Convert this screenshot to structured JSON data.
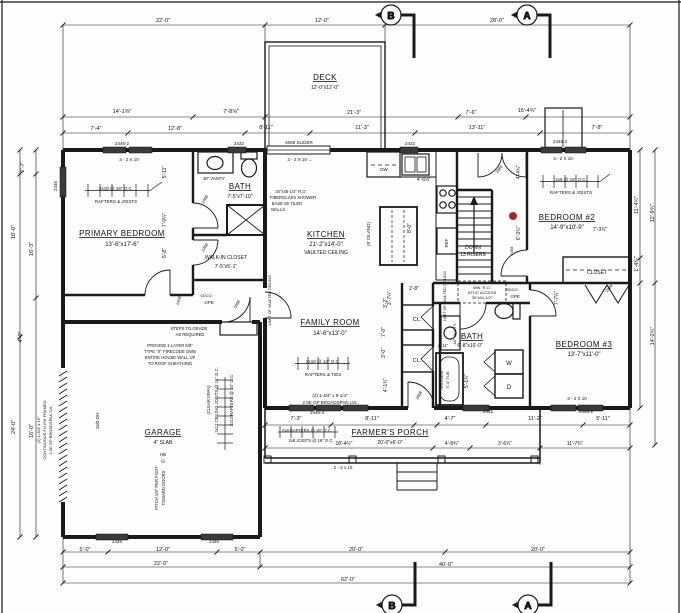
{
  "drawing_type": "first-floor architectural plan",
  "colors": {
    "paper": "#fdfdfd",
    "line": "#1a1a1a",
    "window_fill": "#3a3a3a",
    "red_marker": "#9e2b25"
  },
  "section_markers": {
    "top_b": "B",
    "top_a": "A",
    "bottom_b": "B",
    "bottom_a": "A"
  },
  "rooms": {
    "deck": {
      "name": "DECK",
      "dims": "12'-0\"x12'-0\""
    },
    "primary_bedroom": {
      "name": "PRIMARY BEDROOM",
      "dims": "13'-6\"x17'-6\""
    },
    "bath1": {
      "name": "BATH",
      "dims": "7'-5\"x7'-10\""
    },
    "walkin_closet": {
      "name": "WALK-IN CLOSET",
      "dims": "7'-5\"x5'-1\""
    },
    "kitchen": {
      "name": "KITCHEN",
      "dims": "21'-2\"x14'-0\"",
      "note": "VAULTED CEILING"
    },
    "family_room": {
      "name": "FAMILY ROOM",
      "dims": "14'-6\"x13'-0\""
    },
    "bedroom2": {
      "name": "BEDROOM #2",
      "dims": "14'-9\"x10'-9\""
    },
    "bedroom3": {
      "name": "BEDROOM #3",
      "dims": "13'-7\"x11'-0\""
    },
    "bath2": {
      "name": "BATH",
      "dims": "6'-8\"x10'-0\""
    },
    "garage": {
      "name": "GARAGE",
      "dims": "4\" SLAB"
    },
    "porch": {
      "name": "FARMER'S PORCH",
      "dims": "20'-0\"x6'-0\""
    },
    "closet2": {
      "name": "CLOSET"
    },
    "stairs": {
      "line1": "DOWN",
      "line2": "13 RISERS"
    }
  },
  "labels": [
    {
      "t": "22'-0\"",
      "x": 163,
      "y": 22
    },
    {
      "t": "12'-0\"",
      "x": 322,
      "y": 22
    },
    {
      "t": "28'-0\"",
      "x": 497,
      "y": 22
    },
    {
      "t": "14'-1⅜\"",
      "x": 122,
      "y": 113
    },
    {
      "t": "7'-8⅝\"",
      "x": 231,
      "y": 113
    },
    {
      "t": "21'-3\"",
      "x": 354,
      "y": 114
    },
    {
      "t": "7'-6\"",
      "x": 471,
      "y": 114
    },
    {
      "t": "15'-4¾\"",
      "x": 527,
      "y": 112
    },
    {
      "t": "7'-4\"",
      "x": 96,
      "y": 130
    },
    {
      "t": "12'-8\"",
      "x": 175,
      "y": 130
    },
    {
      "t": "8'-11\"",
      "x": 266,
      "y": 129
    },
    {
      "t": "11'-3\"",
      "x": 362,
      "y": 129
    },
    {
      "t": "13'-11\"",
      "x": 477,
      "y": 129
    },
    {
      "t": "7'-8\"",
      "x": 597,
      "y": 129
    },
    {
      "t": "2446-2",
      "x": 122,
      "y": 145,
      "s": 4.5
    },
    {
      "t": "2432",
      "x": 239,
      "y": 145,
      "s": 4.5
    },
    {
      "t": "6068 SLIDER",
      "x": 299,
      "y": 144,
      "s": 4.5
    },
    {
      "t": "2432",
      "x": 410,
      "y": 145,
      "s": 4.5
    },
    {
      "t": "2446-2",
      "x": 560,
      "y": 143,
      "s": 4.5
    },
    {
      "t": "3 - 2 X 10",
      "x": 129,
      "y": 161,
      "s": 4.5
    },
    {
      "t": "3 - 2 X 10  ←",
      "x": 300,
      "y": 161,
      "s": 4.5
    },
    {
      "t": "3 - 2 X 10",
      "x": 563,
      "y": 160,
      "s": 4.5
    },
    {
      "t": "2446",
      "x": 57,
      "y": 186,
      "r": -90,
      "s": 4.5
    },
    {
      "t": "2'-7\"",
      "x": 24,
      "y": 167,
      "r": -90
    },
    {
      "t": "18'-0\"",
      "x": 15,
      "y": 232,
      "r": -90
    },
    {
      "t": "16'-3\"",
      "x": 33,
      "y": 249,
      "r": -90
    },
    {
      "t": "4'-0\"",
      "x": 22,
      "y": 337,
      "r": -90
    },
    {
      "t": "24'-0\"",
      "x": 15,
      "y": 427,
      "r": -90
    },
    {
      "t": "16'-0\"",
      "x": 33,
      "y": 431,
      "r": -90
    },
    {
      "t": "11'-4¾\"",
      "x": 638,
      "y": 205,
      "r": -90
    },
    {
      "t": "12'-9¾\"",
      "x": 654,
      "y": 213,
      "r": -90
    },
    {
      "t": "1'-4¾\"",
      "x": 638,
      "y": 264,
      "r": -90
    },
    {
      "t": "14'-2¾\"",
      "x": 654,
      "y": 336,
      "r": -90
    },
    {
      "t": "7'-3\"",
      "x": 296,
      "y": 420
    },
    {
      "t": "8'-11\"",
      "x": 372,
      "y": 420
    },
    {
      "t": "4'-7\"",
      "x": 450,
      "y": 420
    },
    {
      "t": "11'-2\"",
      "x": 535,
      "y": 420
    },
    {
      "t": "5'-11\"",
      "x": 603,
      "y": 420
    },
    {
      "t": "18'-4½\"",
      "x": 344,
      "y": 445,
      "s": 5
    },
    {
      "t": "4'-8¾\"",
      "x": 452,
      "y": 445,
      "s": 5
    },
    {
      "t": "3'-6¾\"",
      "x": 505,
      "y": 445,
      "s": 5
    },
    {
      "t": "11'-7¾\"",
      "x": 575,
      "y": 445,
      "s": 5
    },
    {
      "t": "2 - 2 x 10",
      "x": 343,
      "y": 469,
      "s": 4.5
    },
    {
      "t": "2446",
      "x": 117,
      "y": 543,
      "s": 4.5
    },
    {
      "t": "2446",
      "x": 214,
      "y": 543,
      "s": 4.5
    },
    {
      "t": "5'-0\"",
      "x": 85,
      "y": 551
    },
    {
      "t": "12'-0\"",
      "x": 163,
      "y": 551
    },
    {
      "t": "5'-0\"",
      "x": 240,
      "y": 551
    },
    {
      "t": "20'-0\"",
      "x": 356,
      "y": 551
    },
    {
      "t": "20'-0\"",
      "x": 538,
      "y": 551
    },
    {
      "t": "22'-0\"",
      "x": 161,
      "y": 565
    },
    {
      "t": "40'-0\"",
      "x": 446,
      "y": 566
    },
    {
      "t": "62'-0\"",
      "x": 348,
      "y": 581
    },
    {
      "t": "2446-3",
      "x": 317,
      "y": 414,
      "s": 4.5
    },
    {
      "t": "2446",
      "x": 488,
      "y": 413,
      "s": 4.5
    },
    {
      "t": "2446-2",
      "x": 586,
      "y": 413,
      "s": 4.5
    },
    {
      "t": "3 - 2 X 10",
      "x": 577,
      "y": 400,
      "s": 4.5
    },
    {
      "t": "2x10 @ 16\" O.C.",
      "x": 116,
      "y": 190,
      "s": 4.5
    },
    {
      "t": "RAFTERS & JOISTS",
      "x": 116,
      "y": 203,
      "s": 4.5
    },
    {
      "t": "2x6 @ 16\" O.C.",
      "x": 571,
      "y": 181,
      "s": 4.5
    },
    {
      "t": "RAFTERS & JOISTS",
      "x": 571,
      "y": 194,
      "s": 4.5
    },
    {
      "t": "2x10 @ 12\" O.C.",
      "x": 323,
      "y": 363,
      "s": 4.5
    },
    {
      "t": "RAFTERS & TIES",
      "x": 323,
      "y": 376,
      "s": 4.5
    },
    {
      "t": "34\"x48-1/4\" R.O.",
      "x": 291,
      "y": 193,
      "s": 4.2
    },
    {
      "t": "FIBERGLASS SHOWER",
      "x": 293,
      "y": 199,
      "s": 4.2
    },
    {
      "t": "BASE W/ TILED",
      "x": 287,
      "y": 205,
      "s": 4.2
    },
    {
      "t": "WALLS",
      "x": 278,
      "y": 211,
      "s": 4.2
    },
    {
      "t": "48\" VANITY",
      "x": 214,
      "y": 180,
      "s": 4.2
    },
    {
      "t": "(2) 1-3/4\" x 9-1/4\"",
      "x": 330,
      "y": 397,
      "s": 4.5
    },
    {
      "t": "2.0E GP BROADSPAN LVL",
      "x": 330,
      "y": 404,
      "s": 4.5
    },
    {
      "t": "PROVIDE 1 LAYER 5/8\"",
      "x": 170,
      "y": 347,
      "s": 4.2
    },
    {
      "t": "TYPE \"X\" FIRECODE GWB",
      "x": 170,
      "y": 353,
      "s": 4.2
    },
    {
      "t": "ENTIRE HOUSE WALL UP",
      "x": 170,
      "y": 359,
      "s": 4.2
    },
    {
      "t": "TO ROOF SHEATHING",
      "x": 170,
      "y": 365,
      "s": 4.2
    },
    {
      "t": "STEPS TO GRADE",
      "x": 189,
      "y": 330,
      "s": 4.2
    },
    {
      "t": "AS REQUIRED",
      "x": 190,
      "y": 336,
      "s": 4.2
    },
    {
      "t": "2x8 RAFTERS @ 16\" O.C.",
      "x": 307,
      "y": 432,
      "s": 4.2
    },
    {
      "t": "2x6 JOISTS @ 16\" O.C.",
      "x": 311,
      "y": 442,
      "s": 4.2
    },
    {
      "t": "MIN. R.O.",
      "x": 482,
      "y": 289,
      "s": 4
    },
    {
      "t": "ATTIC ACCESS",
      "x": 482,
      "y": 294,
      "s": 4
    },
    {
      "t": "30\"x54-1/2\"",
      "x": 482,
      "y": 299,
      "s": 4
    },
    {
      "t": "SDCO",
      "x": 206,
      "y": 297,
      "s": 4
    },
    {
      "t": "⊙PE",
      "x": 209,
      "y": 304,
      "s": 4.5
    },
    {
      "t": "SDCO",
      "x": 512,
      "y": 291,
      "s": 4
    },
    {
      "t": "⊙PE",
      "x": 515,
      "y": 298,
      "s": 4.5
    },
    {
      "t": "HB",
      "x": 163,
      "y": 456,
      "s": 4.5
    },
    {
      "t": "⊙",
      "x": 163,
      "y": 463,
      "s": 5
    },
    {
      "t": "DW",
      "x": 384,
      "y": 171,
      "s": 4.5
    },
    {
      "t": "REF",
      "x": 448,
      "y": 243,
      "r": -90,
      "s": 4.5
    },
    {
      "t": "(8' ISLAND)",
      "x": 370,
      "y": 234,
      "r": -90,
      "s": 4.5
    },
    {
      "t": "8'-0\"",
      "x": 411,
      "y": 228,
      "r": -90,
      "s": 5
    },
    {
      "t": "4'-6½\"",
      "x": 424,
      "y": 181,
      "s": 5
    },
    {
      "t": "2'-8\"",
      "x": 414,
      "y": 290,
      "s": 5
    },
    {
      "t": "3'-7¼\"",
      "x": 391,
      "y": 298,
      "r": -90,
      "s": 5
    },
    {
      "t": "5'-11\"",
      "x": 166,
      "y": 172,
      "r": -90,
      "s": 5
    },
    {
      "t": "7'-0¼\"",
      "x": 166,
      "y": 220,
      "r": -90,
      "s": 5
    },
    {
      "t": "5'-8\"",
      "x": 166,
      "y": 253,
      "r": -90,
      "s": 5
    },
    {
      "t": "LIMIT OF VAULTED CEILING",
      "x": 271,
      "y": 300,
      "r": -90,
      "s": 3.8
    },
    {
      "t": "LIMIT OF VAULTED CEILING",
      "x": 446,
      "y": 296,
      "r": -90,
      "s": 3.8
    },
    {
      "t": "48\" VANITY",
      "x": 456,
      "y": 334,
      "r": -90,
      "s": 4
    },
    {
      "t": "SHOWER/",
      "x": 443,
      "y": 380,
      "r": -90,
      "s": 4
    },
    {
      "t": "5'-0\" TUB",
      "x": 449,
      "y": 380,
      "r": -90,
      "s": 4
    },
    {
      "t": "2'-11\"",
      "x": 443,
      "y": 347,
      "s": 4.2
    },
    {
      "t": "5'-1¾\"",
      "x": 468,
      "y": 381,
      "r": -90,
      "s": 5
    },
    {
      "t": "3'-2\"",
      "x": 387,
      "y": 303,
      "r": -90,
      "s": 5
    },
    {
      "t": "7'-0\"",
      "x": 385,
      "y": 332,
      "r": -90,
      "s": 5
    },
    {
      "t": "3'-0\"",
      "x": 385,
      "y": 353,
      "r": -90,
      "s": 5
    },
    {
      "t": "4'-1¾\"",
      "x": 387,
      "y": 385,
      "r": -90,
      "s": 5
    },
    {
      "t": "4'-4¾\"",
      "x": 520,
      "y": 172,
      "r": -90,
      "s": 5
    },
    {
      "t": "6'-3¾\"",
      "x": 520,
      "y": 233,
      "r": -90,
      "s": 5
    },
    {
      "t": "7'-3¾\"",
      "x": 600,
      "y": 231,
      "s": 5
    },
    {
      "t": "7'-7¼\"",
      "x": 558,
      "y": 298,
      "r": -90,
      "s": 5
    },
    {
      "t": "2468",
      "x": 206,
      "y": 200,
      "r": -60,
      "s": 4
    },
    {
      "t": "2468",
      "x": 206,
      "y": 248,
      "r": -60,
      "s": 4
    },
    {
      "t": "2468",
      "x": 180,
      "y": 301,
      "r": -75,
      "s": 4
    },
    {
      "t": "3068",
      "x": 238,
      "y": 305,
      "r": -60,
      "s": 4
    },
    {
      "t": "2468",
      "x": 513,
      "y": 251,
      "r": -90,
      "s": 4
    },
    {
      "t": "2668",
      "x": 500,
      "y": 170,
      "r": -50,
      "s": 4
    },
    {
      "t": "2868",
      "x": 610,
      "y": 289,
      "r": -50,
      "s": 4
    },
    {
      "t": "2868",
      "x": 420,
      "y": 396,
      "r": -60,
      "s": 4
    },
    {
      "t": "16/0 DH",
      "x": 99,
      "y": 421,
      "r": -90,
      "s": 4.5
    },
    {
      "t": "PITCH 1/8\" PER FOOT",
      "x": 158,
      "y": 488,
      "r": -90,
      "s": 4.2
    },
    {
      "t": "TOWARD DOORS",
      "x": 165,
      "y": 488,
      "r": -90,
      "s": 4.2
    },
    {
      "t": "(2) 1-3/4\" x 16\"",
      "x": 40,
      "y": 430,
      "r": -90,
      "s": 4
    },
    {
      "t": "CONTINUOUS FLUSH FRAMED",
      "x": 46,
      "y": 430,
      "r": -90,
      "s": 4
    },
    {
      "t": "2.0E GP BROADSPAN LVL",
      "x": 52,
      "y": 430,
      "r": -90,
      "s": 4
    },
    {
      "t": "(CLEAR SPAN)",
      "x": 210,
      "y": 400,
      "r": -90,
      "s": 4.2
    },
    {
      "t": "2x12 CEILING JOISTS @ 16\" O.C.",
      "x": 218,
      "y": 400,
      "r": -90,
      "s": 4.2
    },
    {
      "t": "2x12 RAFTERS @ 16\" O.C.",
      "x": 233,
      "y": 400,
      "r": -90,
      "s": 4.2
    },
    {
      "t": "CL.",
      "x": 417,
      "y": 321,
      "s": 5.5
    },
    {
      "t": "CL.",
      "x": 417,
      "y": 362,
      "s": 5.5
    },
    {
      "t": "W",
      "x": 509,
      "y": 365,
      "s": 6
    },
    {
      "t": "D",
      "x": 509,
      "y": 389,
      "s": 6
    }
  ]
}
